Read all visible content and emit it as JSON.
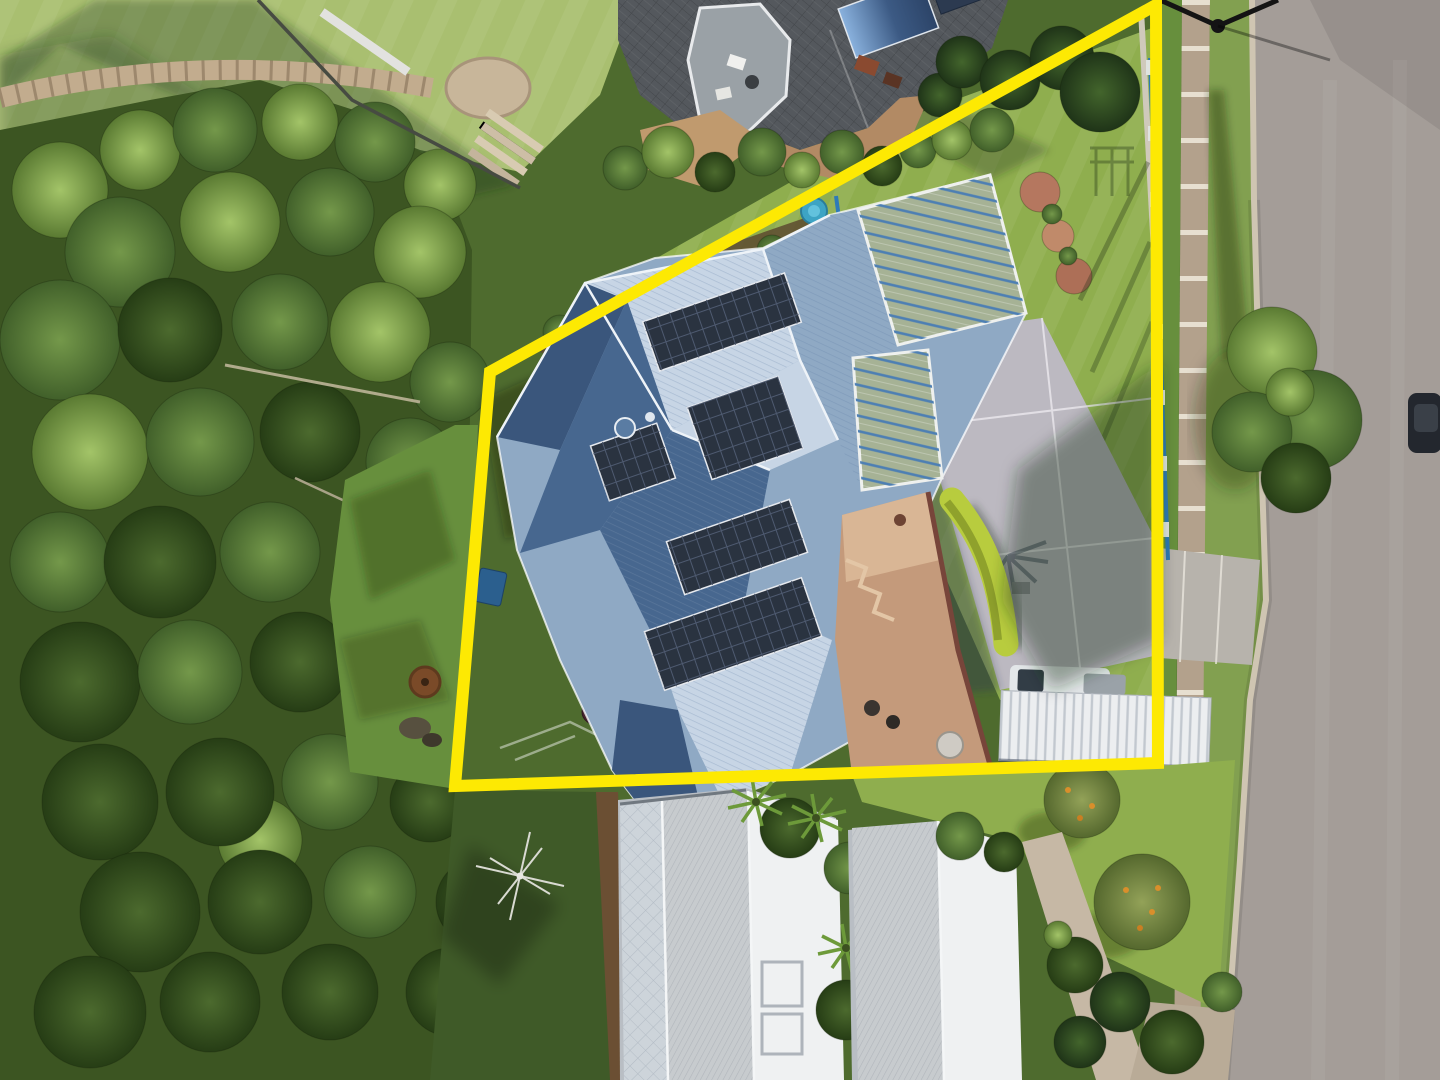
{
  "meta": {
    "title": "Aerial drone photograph of residential property with highlighted lot boundary",
    "width": 1440,
    "height": 1080
  },
  "palette": {
    "boundary_yellow": "#fde903",
    "roof_light": "#c7d5e5",
    "roof_mid": "#8fa9c4",
    "roof_dark": "#47678f",
    "roof_deep": "#3a567c",
    "solar_panel": "#2a3340",
    "garage_green": "#a6b295",
    "garage_stripe": "#4d7fb3",
    "driveway_gray": "#bcb9c1",
    "courtyard_tan": "#c49a7b",
    "hedge_chartreuse": "#b8cc3e",
    "carport_white": "#eceef0",
    "duplex_white": "#eff1f2",
    "duplex_gray": "#c7cbce",
    "duplex_diamond": "#cdd4da",
    "neighbor_roof_charcoal": "#54585d",
    "road_asphalt": "#a49d98",
    "footpath": "#b3a18c",
    "curb": "#cfc5b2",
    "lawn_pale": "#a9bf70",
    "lawn_bright": "#8fae4e",
    "lawn_mid": "#678f3d",
    "lawn_shaded": "#4e6b2e",
    "lawn_dark": "#3f5a28",
    "forest_green": "#3c5522",
    "verge_green": "#82a050",
    "fence_blue": "#2e78b5",
    "pool_blue": "#3da4c4",
    "table_brown": "#7a4a28",
    "car_dark": "#23272e",
    "brick_tan": "#b28a64",
    "dirt_brown": "#5d4a30"
  },
  "scene": {
    "overlay": {
      "label": "property-boundary-outline",
      "color_ref": "boundary_yellow",
      "vertex_count": 4
    },
    "landmarks": [
      {
        "label": "main-house-blue-hip-roof"
      },
      {
        "label": "rooftop-solar-arrays"
      },
      {
        "label": "green-roof-garage-pergola"
      },
      {
        "label": "concrete-driveway"
      },
      {
        "label": "terracotta-courtyard"
      },
      {
        "label": "white-carport"
      },
      {
        "label": "street-and-footpath"
      },
      {
        "label": "neighbor-house-charcoal-roof"
      },
      {
        "label": "white-duplex-roofs"
      },
      {
        "label": "bushland-reserve"
      },
      {
        "label": "kiddie-pool"
      },
      {
        "label": "round-picnic-table"
      },
      {
        "label": "rotary-clothesline"
      }
    ]
  }
}
